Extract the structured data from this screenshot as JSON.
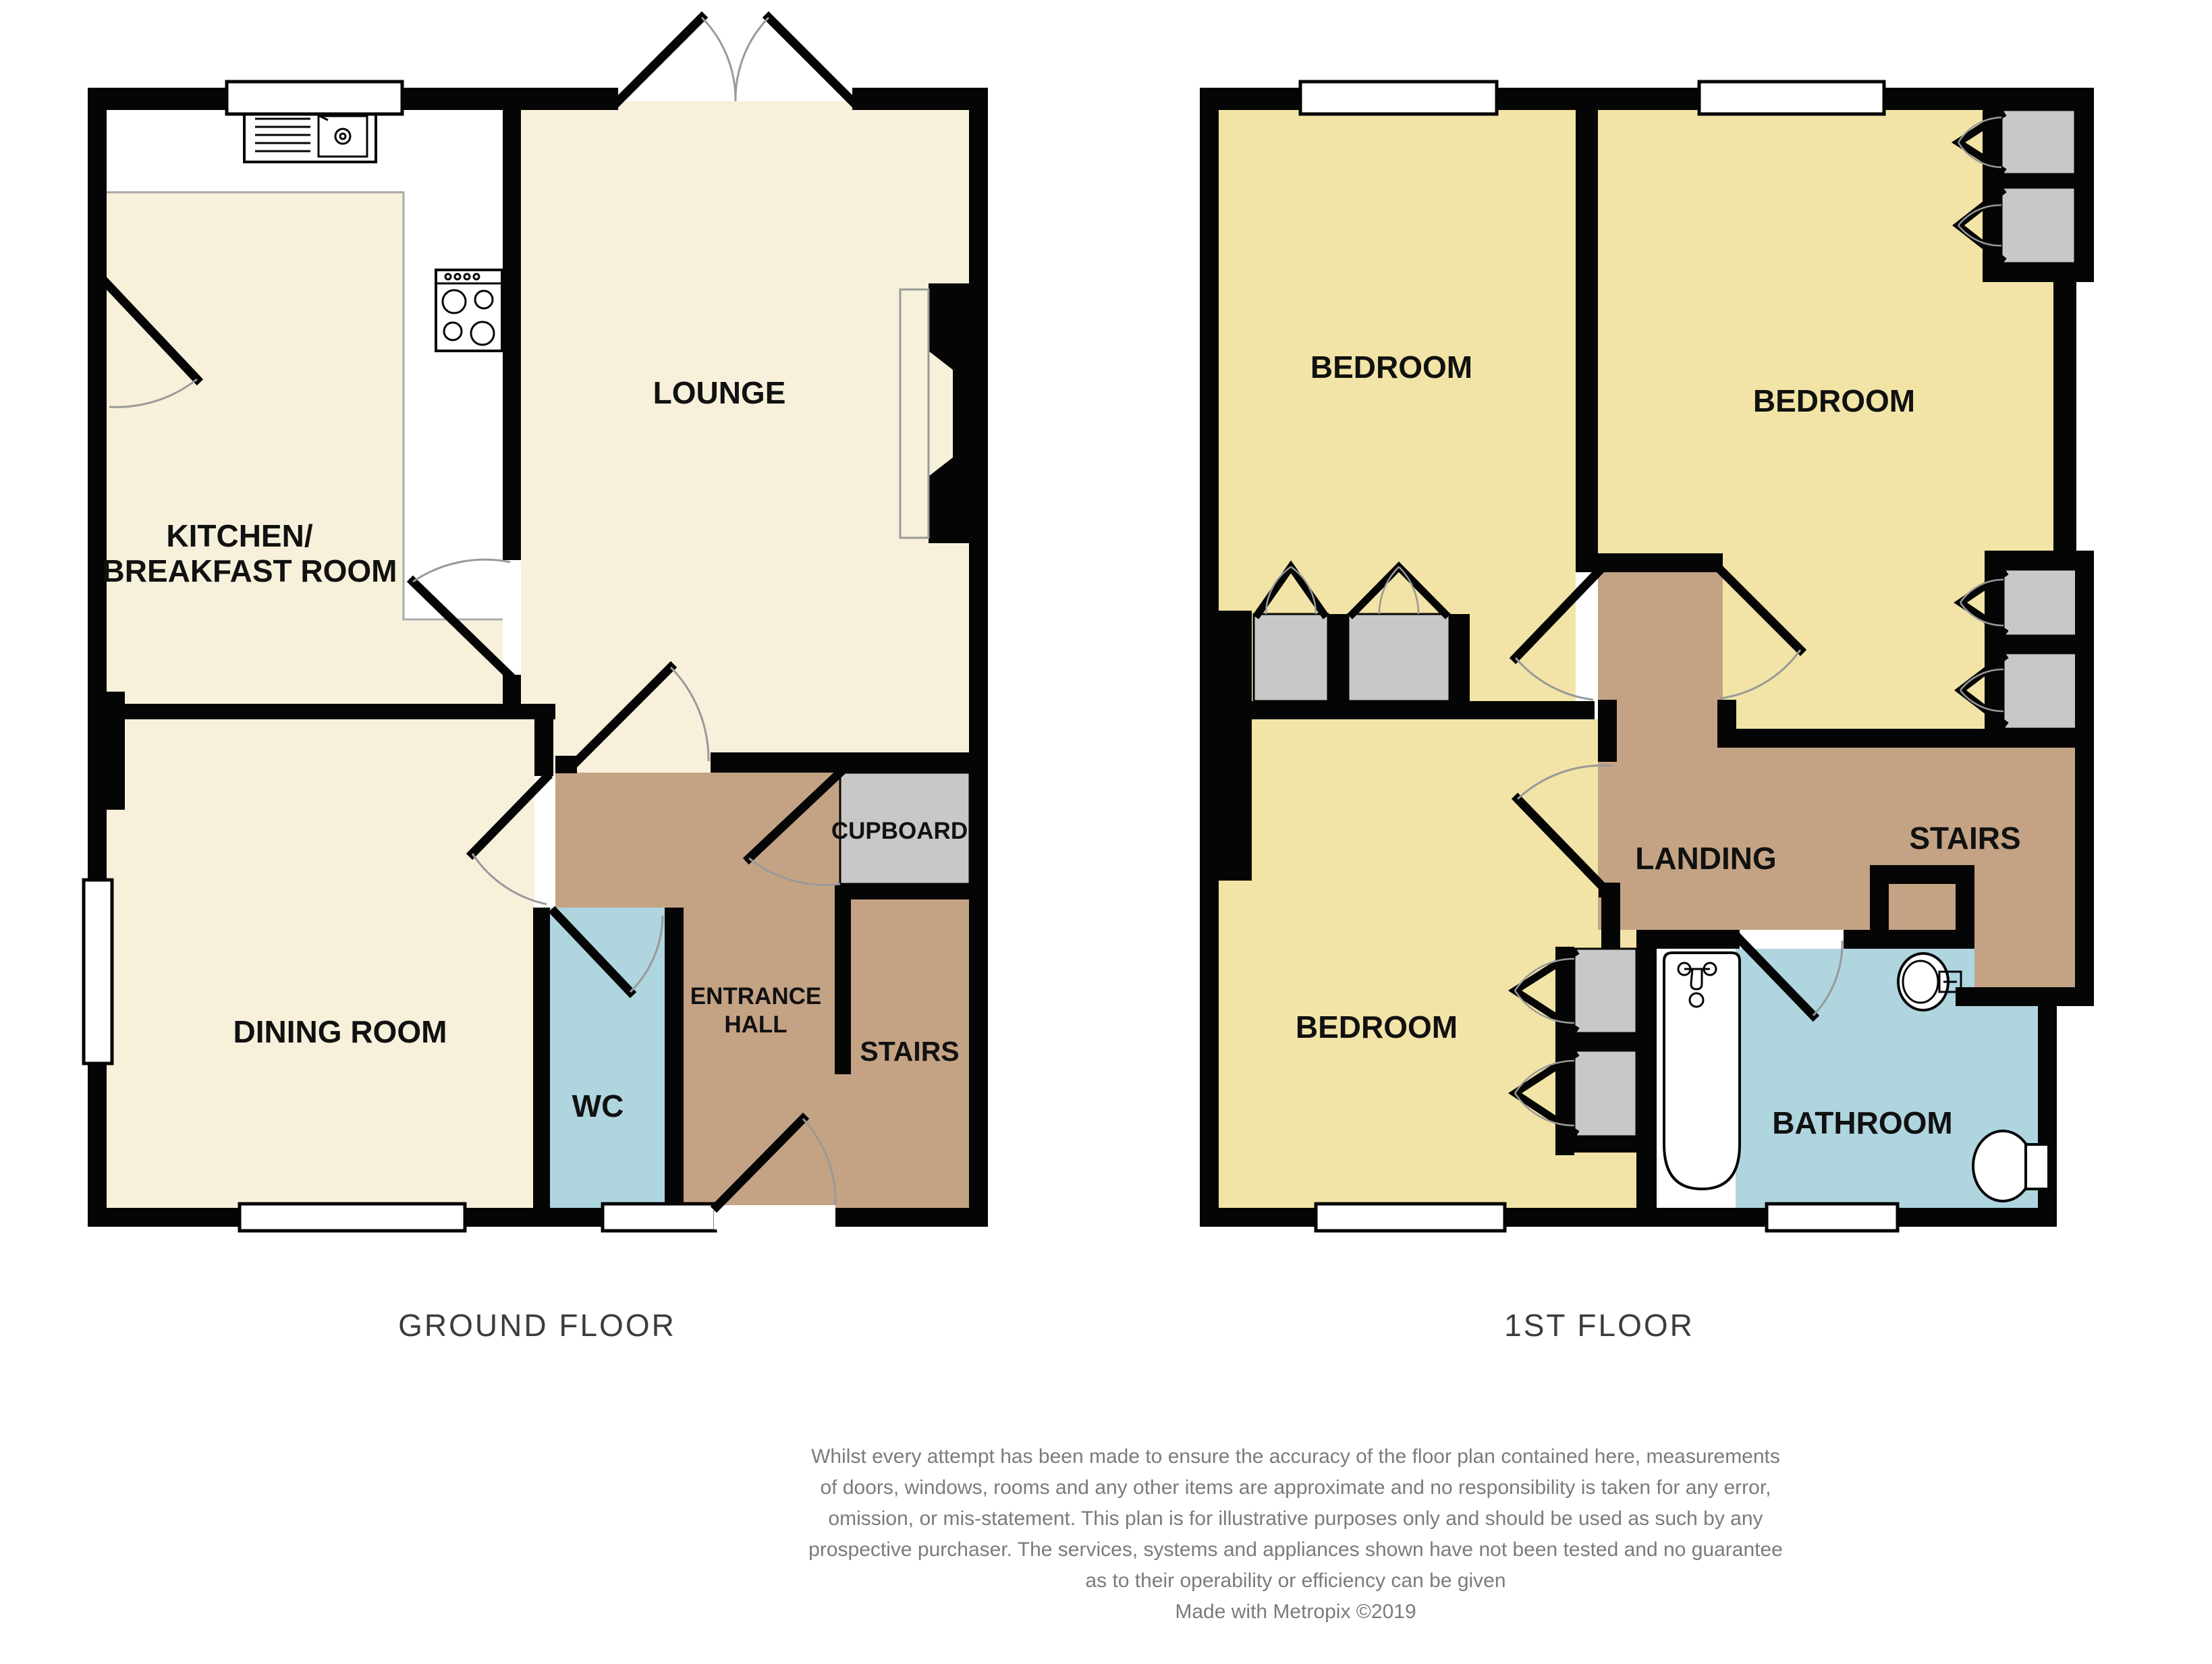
{
  "title": "House floor plan",
  "colors": {
    "wall": "#050505",
    "cream": "#F7F0DB",
    "yellow": "#F2E4A6",
    "brown": "#C4A384",
    "blue": "#AFD5DF",
    "gray": "#C8C8C8",
    "arc": "#999999",
    "counterline": "#AAAAAA",
    "floorlabel": "#3C3C3C",
    "disclaimer": "#7B7B7B"
  },
  "ground_floor": {
    "name": "GROUND FLOOR",
    "rooms": {
      "kitchen_line1": "KITCHEN/",
      "kitchen_line2": "BREAKFAST ROOM",
      "lounge": "LOUNGE",
      "dining": "DINING ROOM",
      "wc": "WC",
      "entrance_line1": "ENTRANCE",
      "entrance_line2": "HALL",
      "stairs": "STAIRS",
      "cupboard": "CUPBOARD"
    },
    "fixtures": [
      "kitchen-sink",
      "cooker-hob",
      "fireplace"
    ]
  },
  "first_floor": {
    "name": "1ST FLOOR",
    "rooms": {
      "bedroom1": "BEDROOM",
      "bedroom2": "BEDROOM",
      "bedroom3": "BEDROOM",
      "landing": "LANDING",
      "stairs": "STAIRS",
      "bathroom": "BATHROOM"
    },
    "fixtures": [
      "bath-tub",
      "wash-basin",
      "toilet",
      "six-built-in-wardrobes"
    ]
  },
  "disclaimer": {
    "line1": "Whilst every attempt has been made to ensure the accuracy of the floor plan contained here, measurements",
    "line2": "of doors, windows, rooms and any other items are approximate and no responsibility is taken for any error,",
    "line3": "omission, or mis-statement. This plan is for illustrative purposes only and should be used as such by any",
    "line4": "prospective purchaser. The services, systems and appliances shown have not been tested and no guarantee",
    "line5": "as to their operability or efficiency can be given",
    "credit": "Made with Metropix ©2019"
  }
}
